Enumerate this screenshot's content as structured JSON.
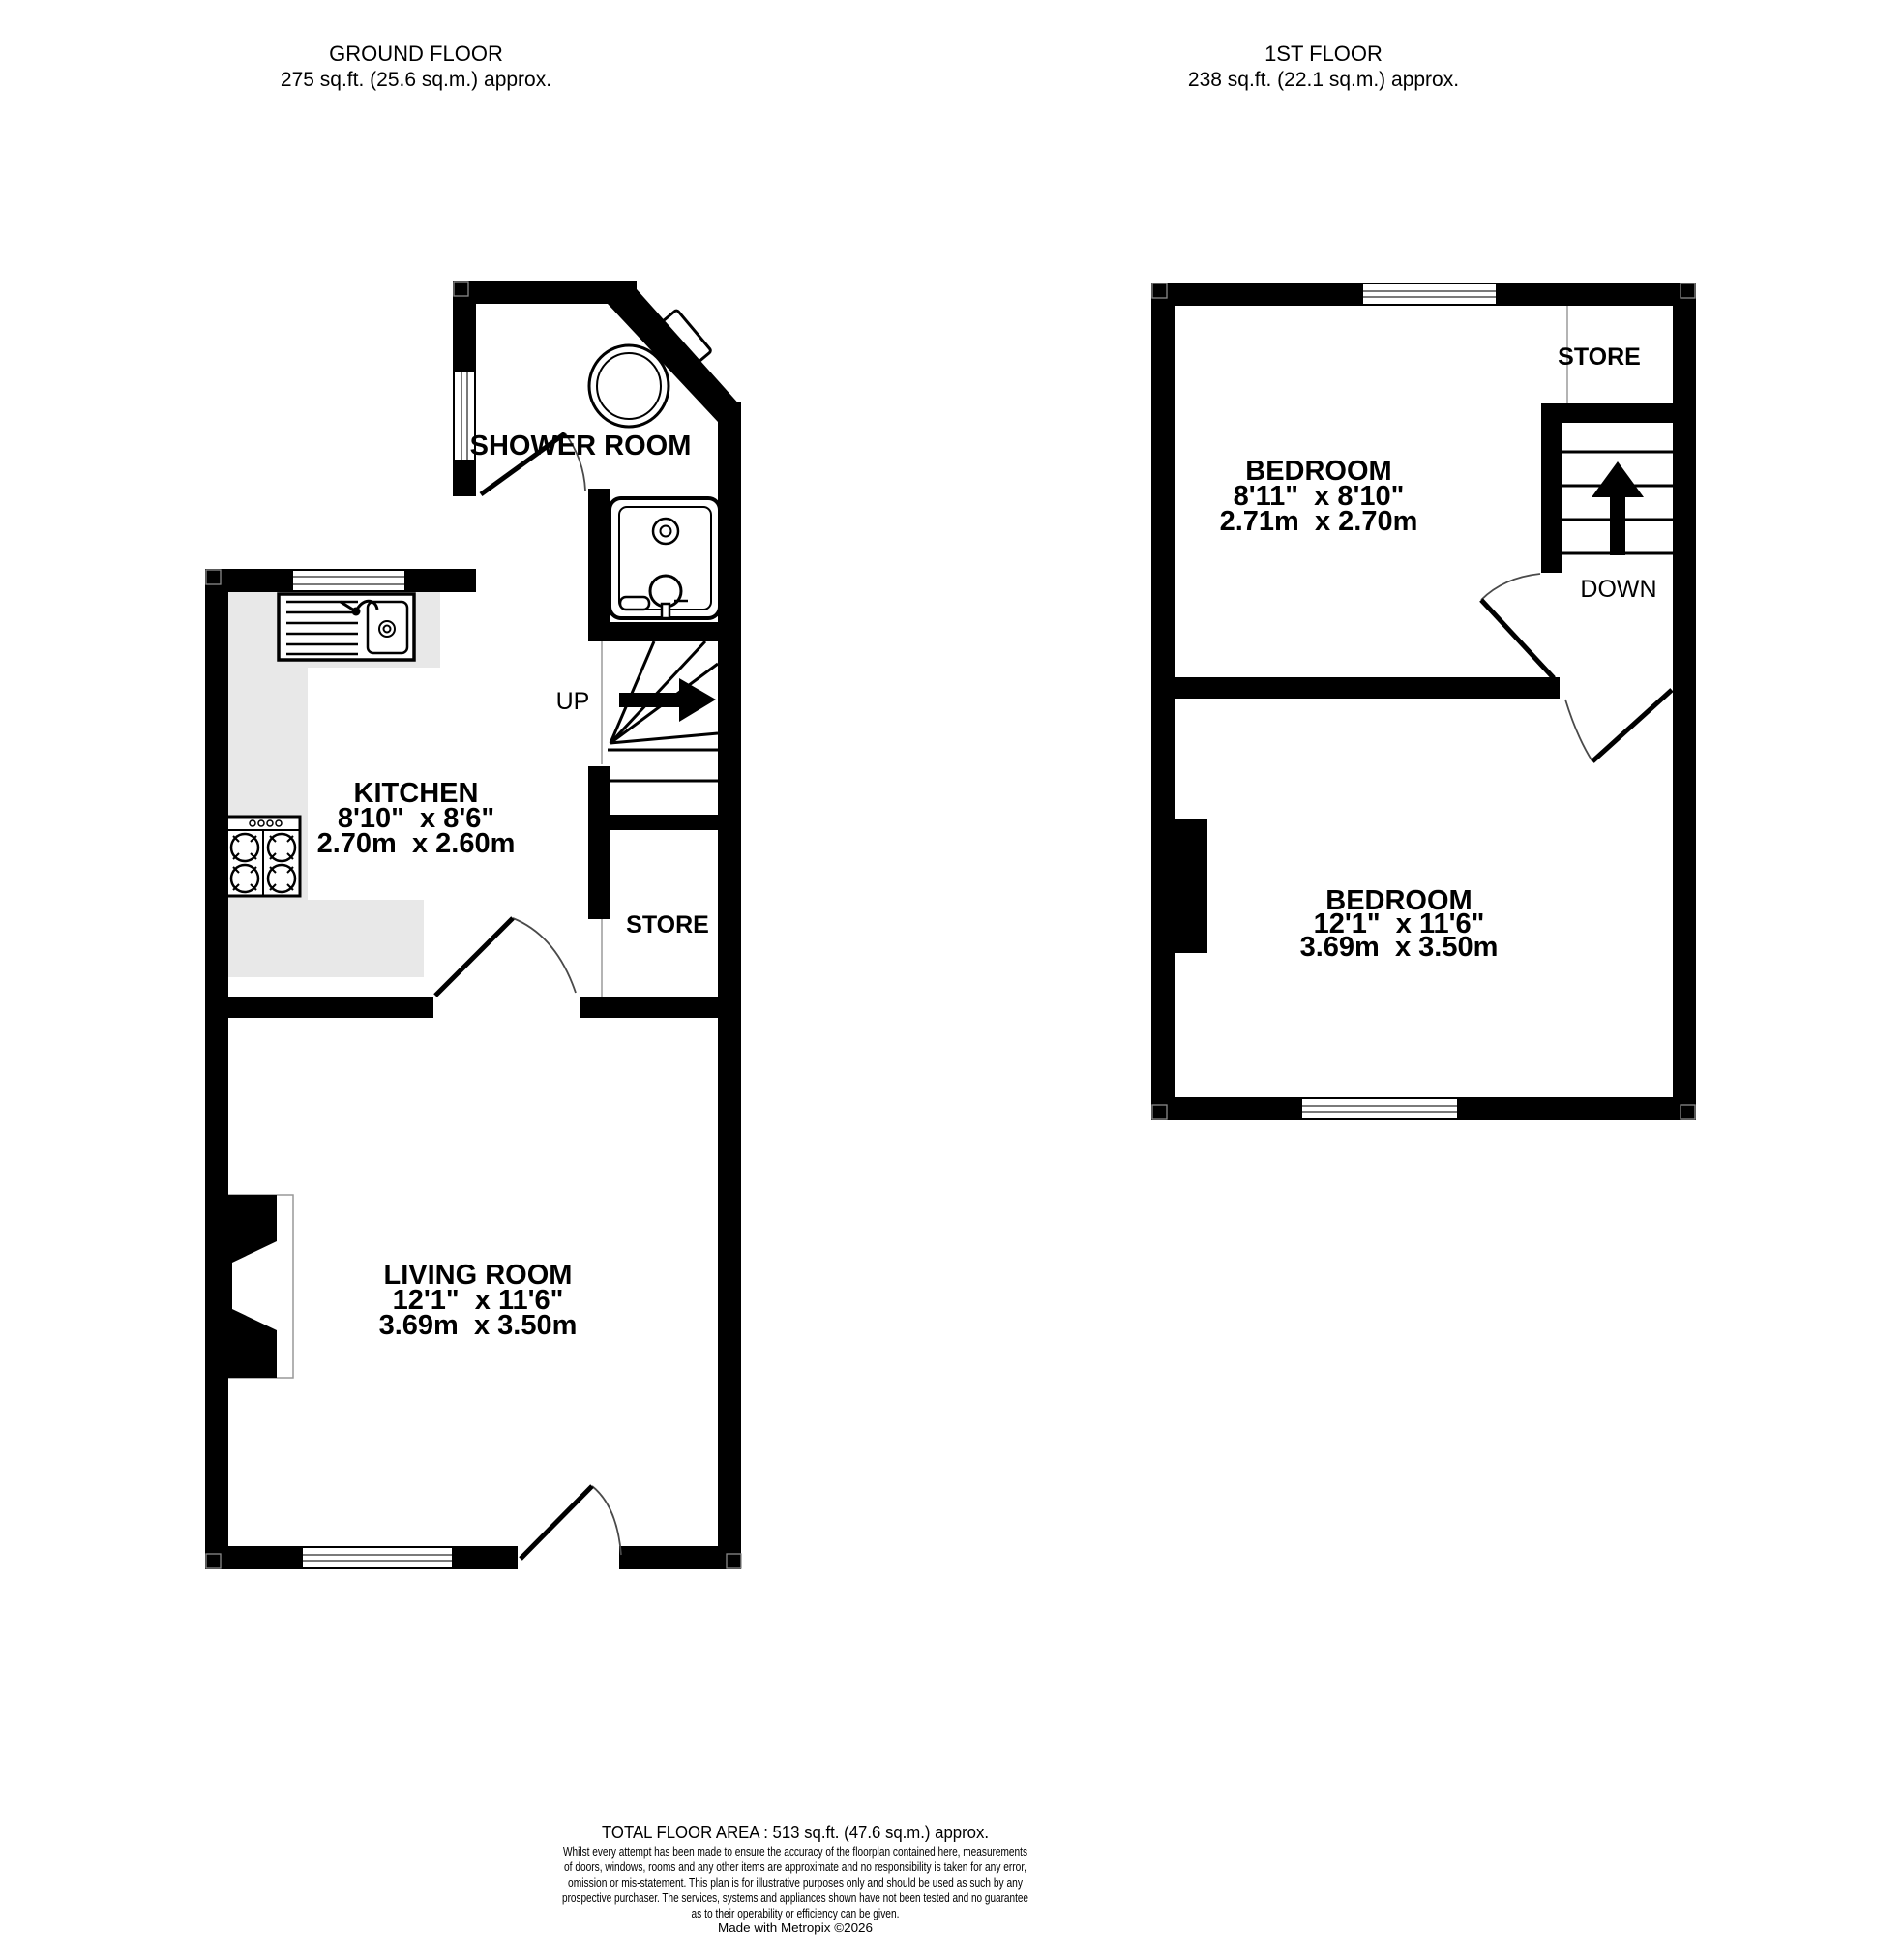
{
  "ground_floor": {
    "title": "GROUND FLOOR",
    "area_label": "275 sq.ft. (25.6 sq.m.) approx.",
    "shower_room": {
      "label": "SHOWER ROOM"
    },
    "kitchen": {
      "label": "KITCHEN",
      "size_imperial": "8'10\"  x 8'6\"",
      "size_metric": "2.70m  x 2.60m"
    },
    "stairs": {
      "label": "UP"
    },
    "store": {
      "label": "STORE"
    },
    "living_room": {
      "label": "LIVING ROOM",
      "size_imperial": "12'1\"  x 11'6\"",
      "size_metric": "3.69m  x 3.50m"
    }
  },
  "first_floor": {
    "title": "1ST FLOOR",
    "area_label": "238 sq.ft. (22.1 sq.m.) approx.",
    "store": {
      "label": "STORE"
    },
    "stairs": {
      "label": "DOWN"
    },
    "bedroom_1": {
      "label": "BEDROOM",
      "size_imperial": "8'11\"  x 8'10\"",
      "size_metric": "2.71m  x 2.70m"
    },
    "bedroom_2": {
      "label": "BEDROOM",
      "size_imperial": "12'1\"  x 11'6\"",
      "size_metric": "3.69m  x 3.50m"
    }
  },
  "footer": {
    "total_area": "TOTAL FLOOR AREA : 513 sq.ft. (47.6 sq.m.) approx.",
    "disclaimer": [
      "Whilst every attempt has been made to ensure the accuracy of the floorplan contained here, measurements",
      "of doors, windows, rooms and any other items are approximate and no responsibility is taken for any error,",
      "omission or mis-statement. This plan is for illustrative purposes only and should be used as such by any",
      "prospective purchaser. The services, systems and appliances shown have not been tested and no guarantee",
      "as to their operability or efficiency can be given."
    ],
    "credit": "Made with Metropix ©2026"
  },
  "colors": {
    "wall": "#000000",
    "background": "#ffffff",
    "kitchen_counter": "#e8e8e8",
    "window_mullion": "#7a7a7a",
    "door_arc": "#4a4a4a",
    "partition_line": "#9a9a9a"
  }
}
